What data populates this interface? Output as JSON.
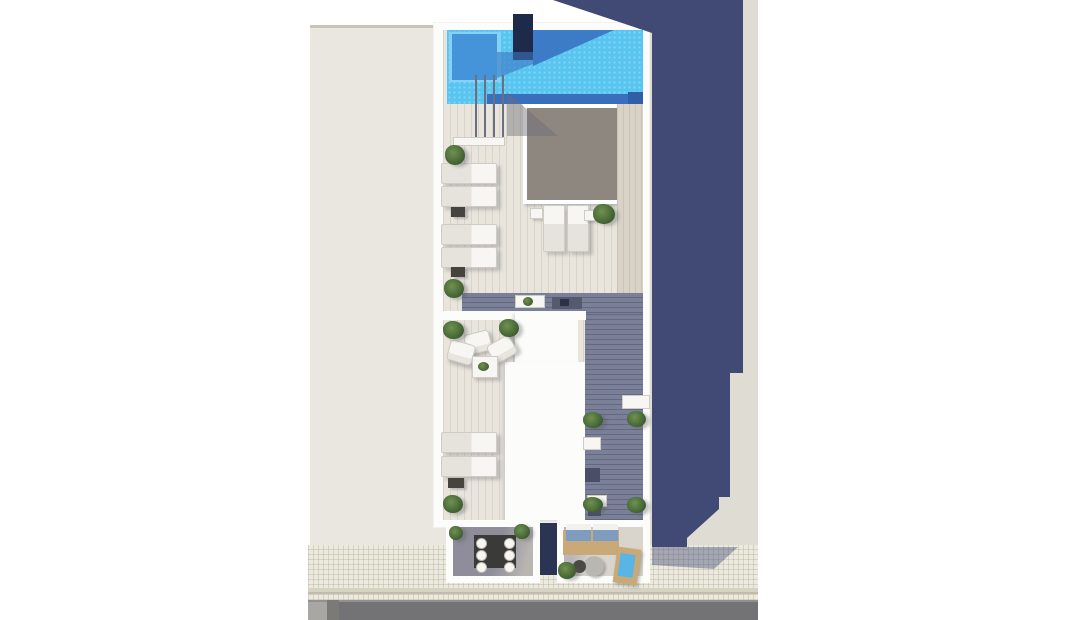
{
  "scene": {
    "type": "aerial-3d-architectural-render",
    "description": "Top-down 3D render of a narrow building rooftop solarium with swimming pool, sun deck, skylight, lounge furniture and two street-side terraces; long blue-grey shadow cast to the right onto pale ground, sidewalk and road at bottom.",
    "labels": {
      "building": "Rooftop solarium",
      "pool": "Swimming pool",
      "pool_shelf": "Pool tanning shelf",
      "chimney": "Stair bulkhead",
      "skylight": "Skylight over atrium",
      "sun_lounger": "Sun lounger",
      "side_table": "Side table",
      "armchair": "Lounge armchair",
      "coffee_table": "Coffee table",
      "plant": "Potted plant",
      "stairs": "Pool stairs with railing",
      "dark_deck": "Grey timber walkway",
      "roof_volume": "White roof volume",
      "terrace_left": "Dining terrace",
      "terrace_right": "Lounge terrace",
      "dining_set": "Dining table with six chairs",
      "sofa": "Outdoor sofa with blue cushions",
      "jacuzzi": "Plunge tub",
      "shadow": "Building cast shadow",
      "sidewalk": "Tiled sidewalk",
      "road": "Asphalt road"
    },
    "inventory": {
      "sun_loungers": 8,
      "armchairs": 3,
      "dining_chairs": 6,
      "plants": 14,
      "terraces": 2,
      "pools": 1,
      "skylights": 1
    }
  },
  "colors": {
    "background": "#ffffff",
    "ground_left": "#eae7e0",
    "ground_left_edge": "#c7c4ba",
    "ground_right": "#dfdcd3",
    "shadow_navy": "#414a74",
    "frame_white": "#fcfcfa",
    "deck_light": "#e9e5dc",
    "deck_dark": "#7b8099",
    "strip_beige": "#d9d3c7",
    "pool_water": "#58c5f0",
    "pool_shelf": "#85d2f4",
    "pool_shelf_inner": "#4594d9",
    "pool_shadow": "#3a74c2",
    "pool_bottom": "#3a6fbd",
    "chimney_navy": "#1e2a4a",
    "skylight_gray": "#8d8780",
    "white_furniture": "#f7f6f2",
    "furniture_line": "#cfccc5",
    "table_dark": "#45443f",
    "mat_dark": "#555a6e",
    "plant": "#4a6b38",
    "plant_dark": "#2f4a24",
    "plant_light": "#6f9150",
    "terrace_floor_shadow": "#8e8d99",
    "terrace_floor_light": "#d9d5cc",
    "gap_navy": "#2b3452",
    "wood_tan": "#c9a978",
    "sofa_blue": "#7e9cc0",
    "jacuzzi_blue": "#58b5e6",
    "sidewalk": "#eceadf",
    "curb_a": "#d6d3c3",
    "curb_b": "#bfbcae",
    "road": "#737376",
    "road_light": "#919193",
    "road_block": "#a8a7a3",
    "road_block_dark": "#7b7a77"
  }
}
